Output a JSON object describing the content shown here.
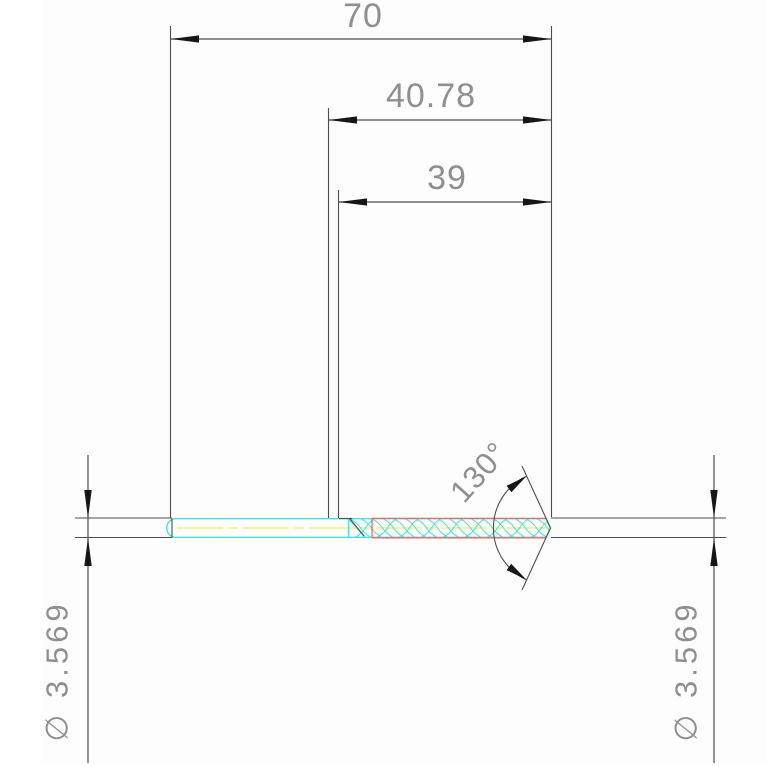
{
  "drawing": {
    "kind": "technical-drawing-drill-side-view",
    "labels": {
      "overall_length": "70",
      "shank_to_tip_length": "40.78",
      "flute_length": "39",
      "point_angle": "130°",
      "diameter_left": "∅ 3.569",
      "diameter_right": "∅ 3.569"
    },
    "values": {
      "overall_length": 70,
      "shank_to_tip_length": 40.78,
      "flute_length": 39,
      "point_angle_deg": 130,
      "diameter": 3.569
    },
    "colors": {
      "background": "#fcfdfc",
      "line": "#4d4d4d",
      "text": "#8f8f8f",
      "arrow": "#161616",
      "drill_outline_cyan": "#49dfdf",
      "flute_edge_red": "#ff5a52",
      "centerline_yellow": "#f2f17c"
    }
  }
}
